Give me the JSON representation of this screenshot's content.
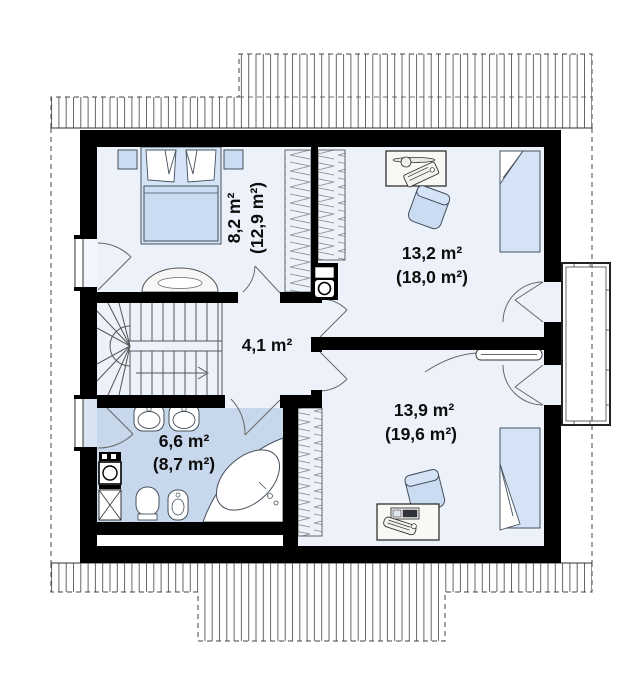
{
  "plan": {
    "type": "attic-floor-plan",
    "rooms": [
      {
        "key": "bedroom-left",
        "area": "8,2 m²",
        "area_total": "(12,9 m²)"
      },
      {
        "key": "bedroom-top-right",
        "area": "13,2 m²",
        "area_total": "(18,0 m²)"
      },
      {
        "key": "hallway",
        "area": "4,1 m²",
        "area_total": ""
      },
      {
        "key": "bathroom",
        "area": "6,6 m²",
        "area_total": "(8,7 m²)"
      },
      {
        "key": "bedroom-bottom-right",
        "area": "13,9 m²",
        "area_total": "(19,6 m²)"
      }
    ],
    "colors": {
      "wall": "#000000",
      "floor": "#edf2fa",
      "bathroom_floor": "#c8d8ec",
      "furniture_fill": "#c9dcf2",
      "bed_fill": "#d5e3f6",
      "outline": "#45505c",
      "hatch_line": "#666666"
    }
  }
}
